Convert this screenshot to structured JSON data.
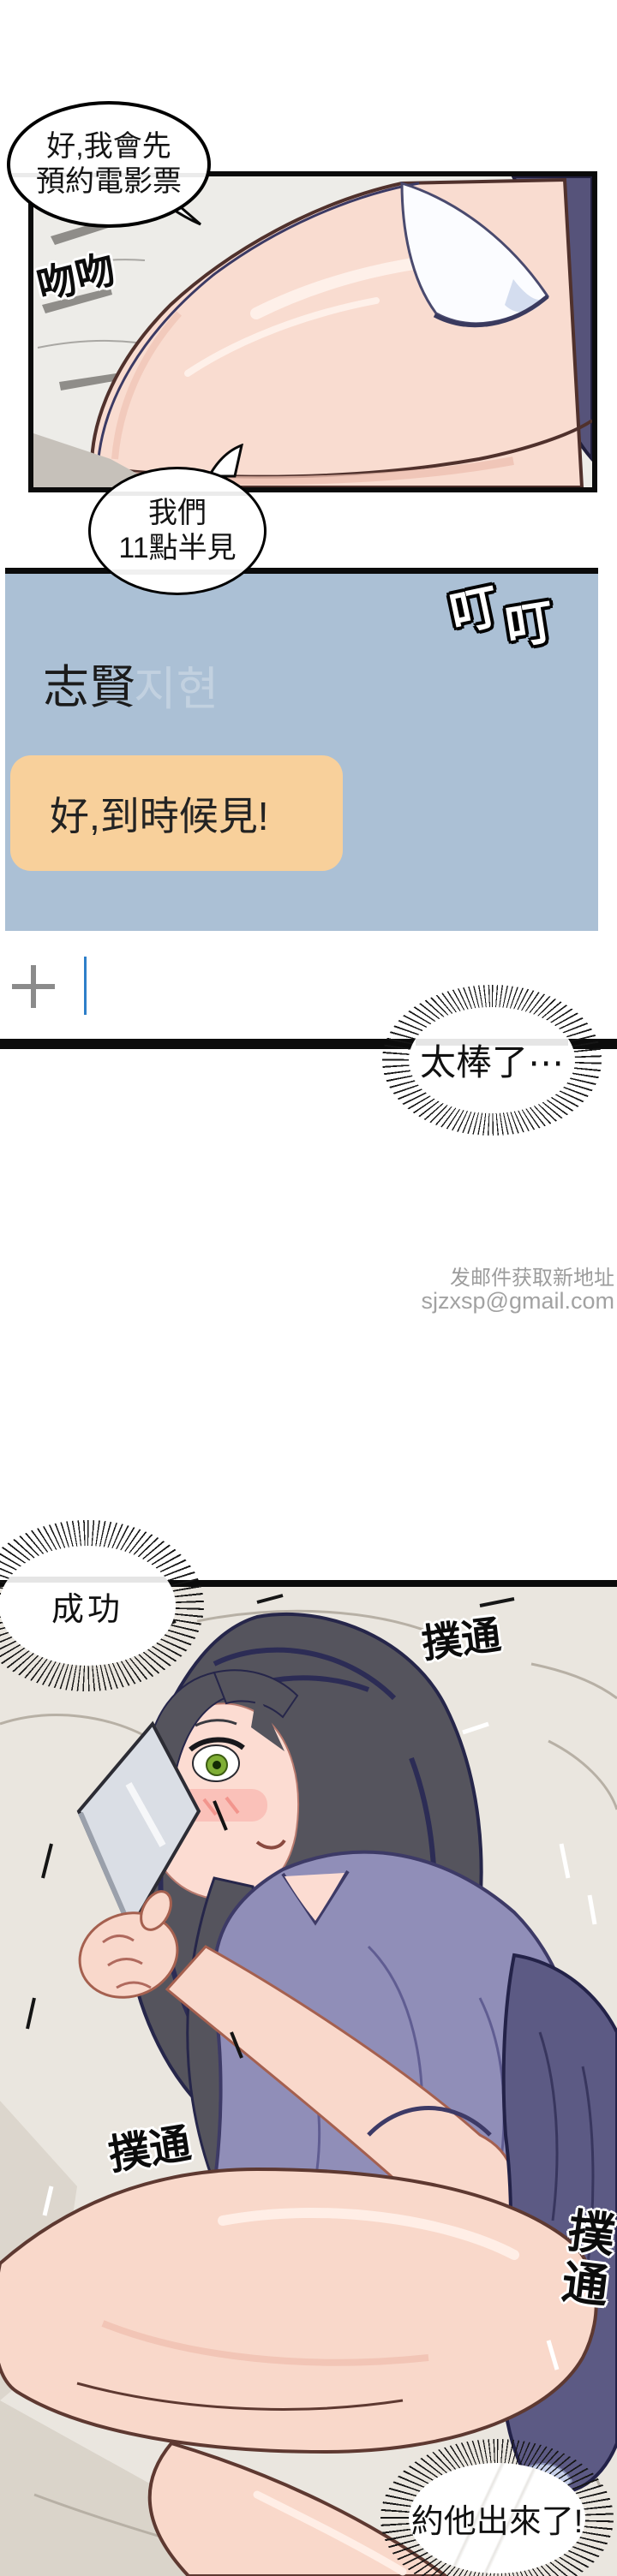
{
  "speech": {
    "booking": {
      "line1": "好,我會先",
      "line2": "預約電影票"
    },
    "meet": {
      "line1": "我們",
      "line2": "11點半見"
    },
    "awesome": "太棒了⋯",
    "success": "成功",
    "asked_out": "約他出來了!"
  },
  "sfx": {
    "typing": "吻吻",
    "ding": "叮叮",
    "thump": "撲通"
  },
  "chat": {
    "contact_name": "志賢",
    "ghost_name": "지현",
    "message": "好,到時候見!"
  },
  "watermark": {
    "line1": "发邮件获取新地址",
    "line2": "sjzxsp@gmail.com"
  },
  "colors": {
    "chat_panel": "#abc0d5",
    "message_bubble": "#f8d09b",
    "cursor_blue": "#2e7fc9",
    "plus_gray": "#8b8b8b",
    "bed": "#eae6df",
    "skin": "#f9dcd0",
    "shirt": "#908eb8",
    "hair": "#55545d"
  }
}
